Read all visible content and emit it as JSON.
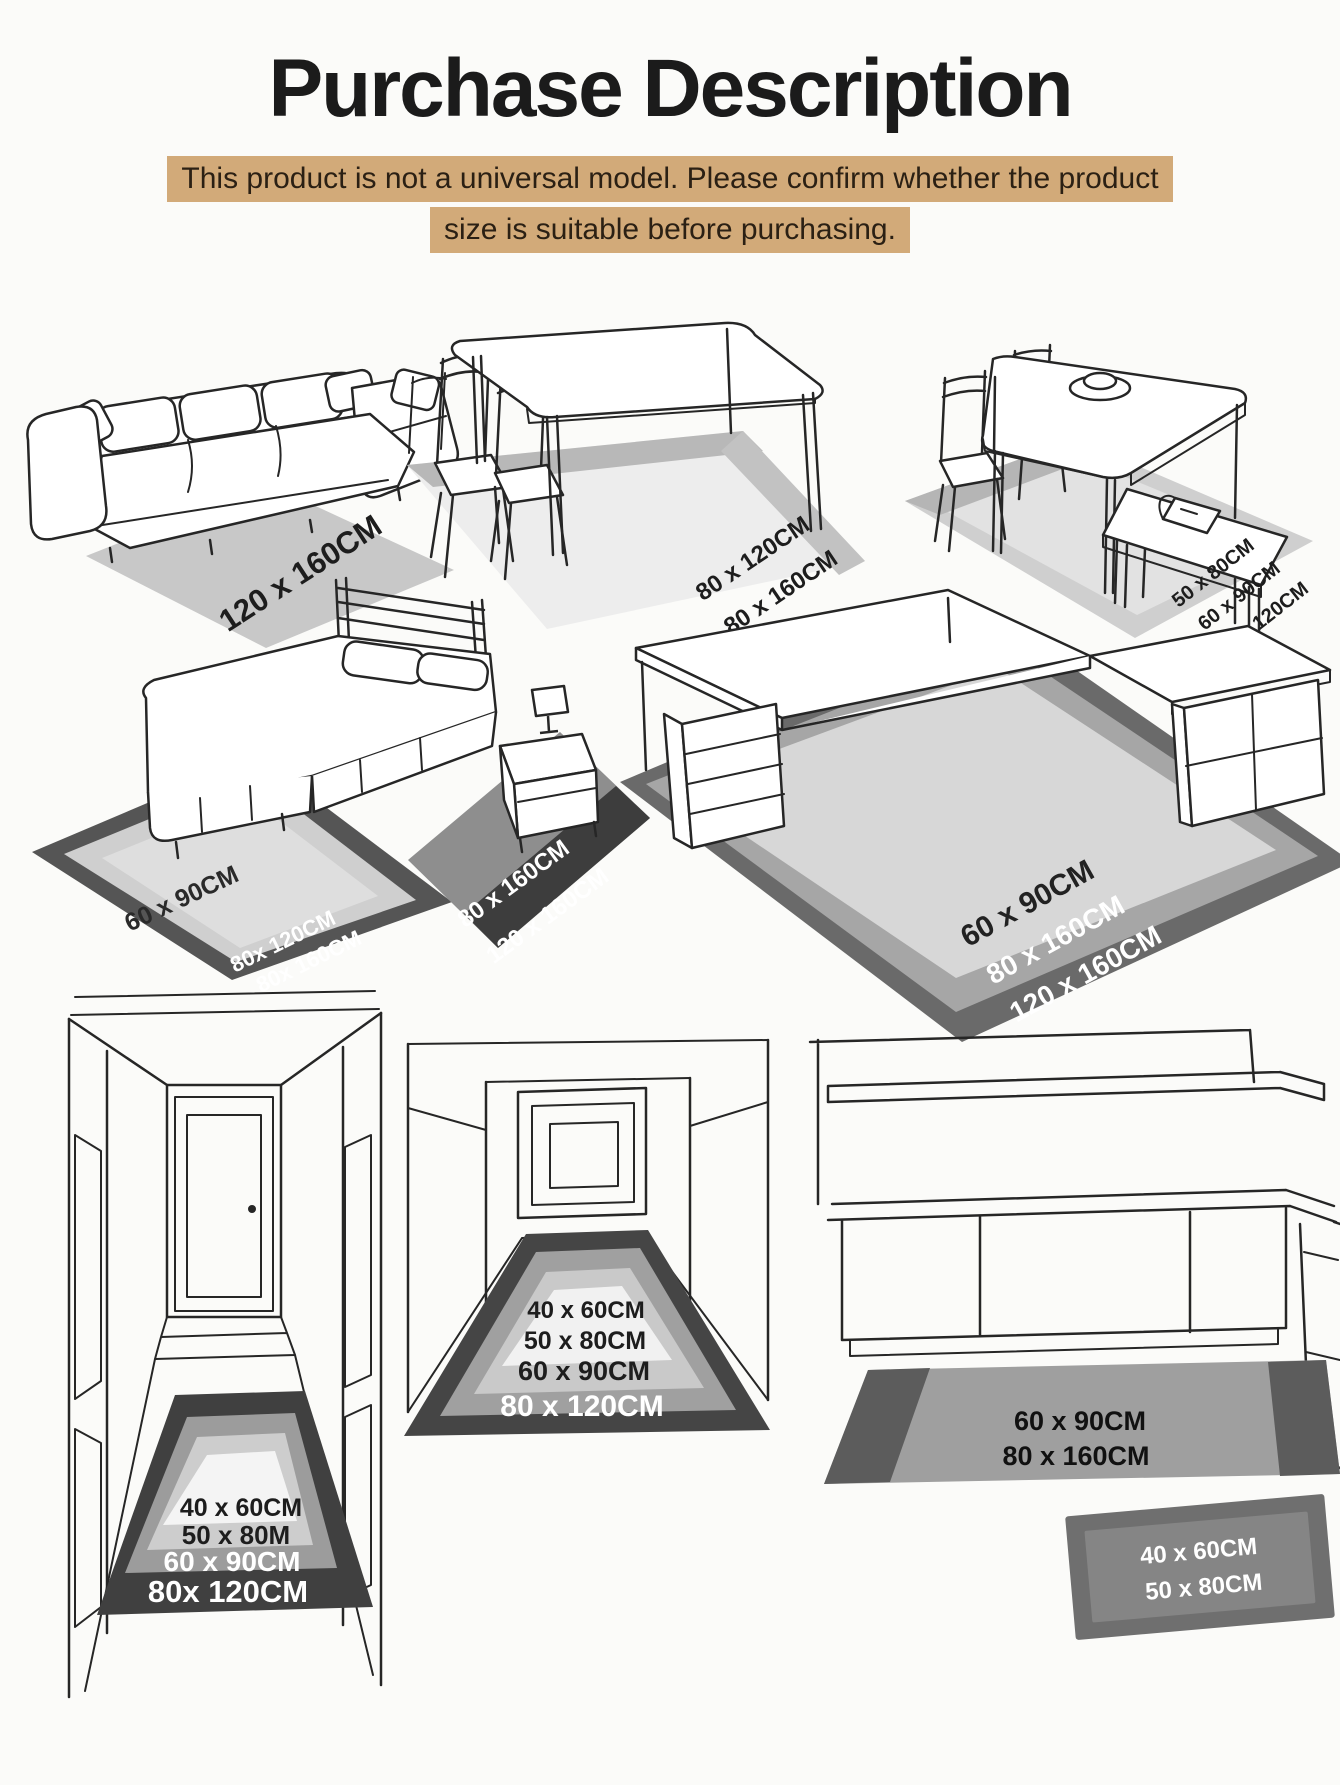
{
  "title": "Purchase Description",
  "notice": {
    "line1": "This product is not a universal model. Please confirm whether the product",
    "line2": "size is suitable before purchasing."
  },
  "colors": {
    "notice_bg": "#d2aa79",
    "rug_light": "#c8c8c8",
    "rug_mid": "#9f9f9f",
    "rug_dark": "#4a4a4a"
  },
  "scenes": {
    "sofa": {
      "rug_label": "120 x 160CM"
    },
    "dining_table": {
      "labels": [
        "80 x 120CM",
        "80 x 160CM"
      ]
    },
    "dining_bench": {
      "labels": [
        "50 x 80CM",
        "60 x 90CM",
        "80x 120CM"
      ]
    },
    "bed": {
      "side_rug_labels": [
        "60 x 90CM",
        "80x 120CM",
        "80x 160CM"
      ],
      "foot_rug_labels": [
        "80 x 160CM",
        "120 x 160CM"
      ]
    },
    "desk": {
      "labels": [
        "60 x 90CM",
        "80 x 160CM",
        "120 x 160CM"
      ]
    },
    "hallway": {
      "labels": [
        "40 x 60CM",
        "50 x 80M",
        "60 x 90CM",
        "80x 120CM"
      ]
    },
    "corridor": {
      "labels": [
        "40 x 60CM",
        "50 x 80CM",
        "60 x 90CM",
        "80 x 120CM"
      ]
    },
    "kitchen": {
      "runner_labels": [
        "60 x 90CM",
        "80 x 160CM"
      ],
      "mat_labels": [
        "40 x 60CM",
        "50 x 80CM"
      ]
    }
  }
}
